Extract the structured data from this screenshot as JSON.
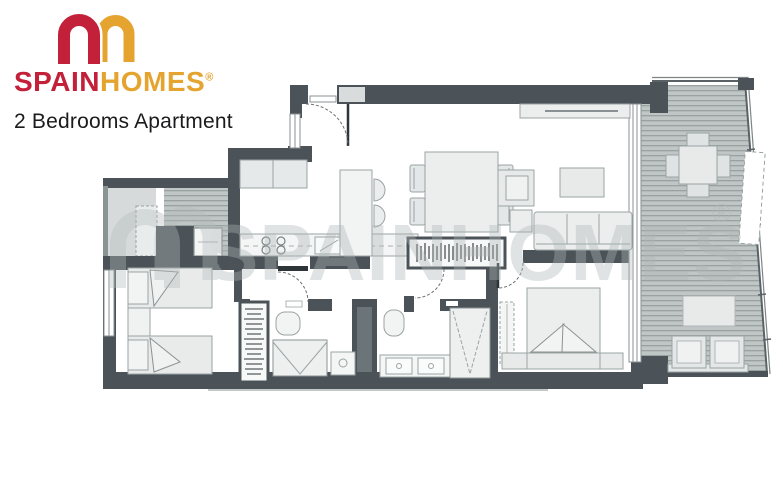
{
  "header": {
    "brand_spain": "SPAIN",
    "brand_homes": "HOMES",
    "registered_mark": "®",
    "subtitle": "2 Bedrooms Apartment"
  },
  "watermark": {
    "text": "SPAINHOMES",
    "registered_mark": "®"
  },
  "colors": {
    "brand_red": "#c3203a",
    "brand_amber": "#e5a430",
    "wall": "#4b5358",
    "deck_base": "#c0c6c6",
    "deck_stripe": "#99a1a1",
    "furniture_fill": "#eceeee",
    "furniture_outline": "#9aa3a3",
    "title_text": "#1b1b1d"
  },
  "floor_plan": {
    "kind": "2-bedroom apartment architectural floor plan with open kitchen and living-dining room, two bathrooms, wardrobes, two bedrooms and an L-shaped terrace"
  }
}
